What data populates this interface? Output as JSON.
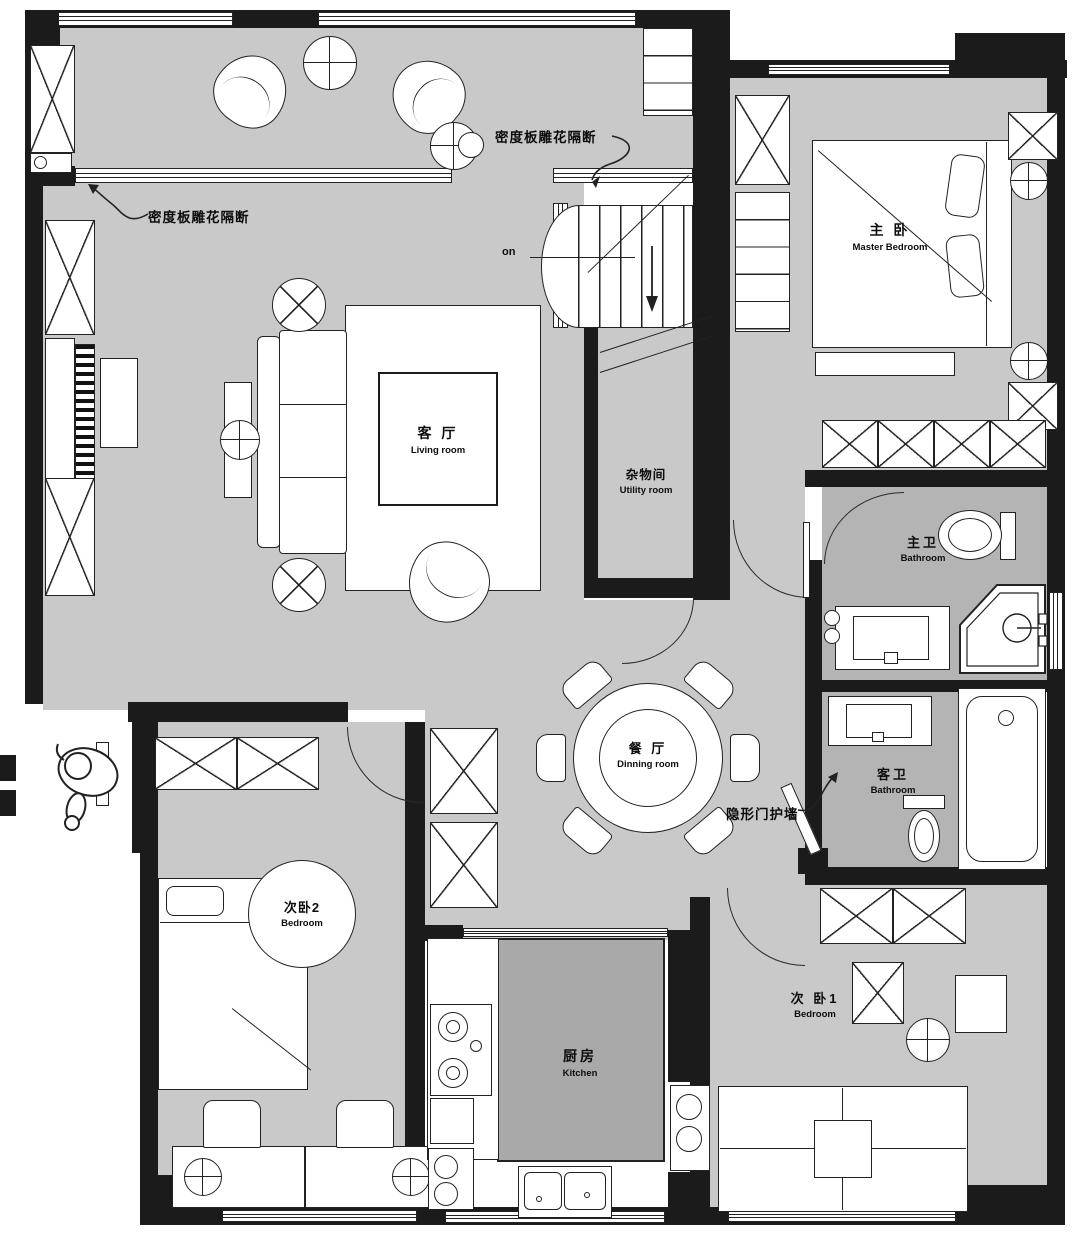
{
  "title": "apartment-floor-plan",
  "rooms": {
    "living": {
      "zh": "客 厅",
      "en": "Living room"
    },
    "master": {
      "zh": "主 卧",
      "en": "Master Bedroom"
    },
    "utility": {
      "zh": "杂物间",
      "en": "Utility room"
    },
    "master_bath": {
      "zh": "主卫",
      "en": "Bathroom"
    },
    "guest_bath": {
      "zh": "客卫",
      "en": "Bathroom"
    },
    "dining": {
      "zh": "餐 厅",
      "en": "Dinning room"
    },
    "bedroom2": {
      "zh": "次卧2",
      "en": "Bedroom"
    },
    "bedroom1": {
      "zh": "次 卧1",
      "en": "Bedroom"
    },
    "kitchen": {
      "zh": "厨房",
      "en": "Kitchen"
    }
  },
  "annotations": {
    "partition_top": "密度板雕花隔断",
    "partition_left": "密度板雕花隔断",
    "hidden_door": "隐形门护墙",
    "stair_direction": "on"
  },
  "colors": {
    "floor": "#c9c9c9",
    "bathroom_floor": "#b4b4b4",
    "kitchen_floor": "#a9a9a9",
    "wall": "#1b1b1b",
    "line": "#222222"
  }
}
